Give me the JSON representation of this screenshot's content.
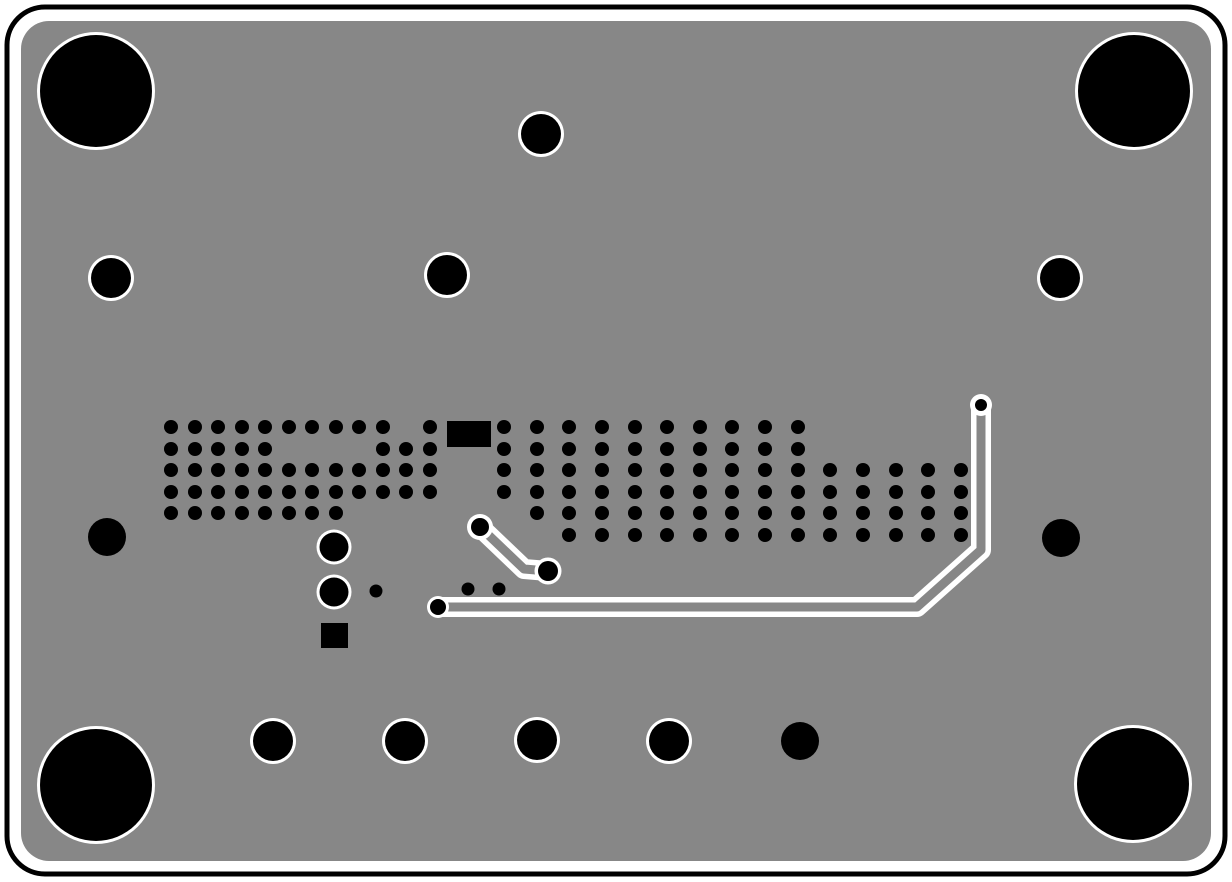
{
  "board": {
    "type": "pcb-layer-render",
    "canvas": {
      "width": 1232,
      "height": 882
    },
    "colors": {
      "background": "#ffffff",
      "substrate": "#878787",
      "drill": "#000000",
      "trace_outline": "#ffffff",
      "board_edge": "#000000"
    },
    "edge_outline": {
      "x": 7,
      "y": 7,
      "width": 1218,
      "height": 867,
      "radius": 38,
      "stroke_width": 5
    },
    "substrate": {
      "x": 21,
      "y": 21,
      "width": 1190,
      "height": 840,
      "radius": 28
    },
    "mounting_holes": {
      "radius": 56,
      "ring_width": 3,
      "positions": [
        [
          96,
          91
        ],
        [
          1134,
          91
        ],
        [
          96,
          785
        ],
        [
          1133,
          784
        ]
      ]
    },
    "ringed_holes": {
      "radius": 20,
      "ring_width": 3,
      "positions": [
        [
          541,
          134
        ],
        [
          111,
          278
        ],
        [
          447,
          275
        ],
        [
          1060,
          278
        ],
        [
          273,
          741
        ],
        [
          405,
          741
        ],
        [
          537,
          740
        ],
        [
          669,
          741
        ]
      ]
    },
    "plain_holes": {
      "radius": 19,
      "positions": [
        [
          107,
          537
        ],
        [
          1061,
          538
        ],
        [
          800,
          741
        ]
      ]
    },
    "ringed_vias": {
      "radius": 14.5,
      "ring_width": 3,
      "positions": [
        [
          334,
          547
        ],
        [
          334,
          592
        ]
      ]
    },
    "via_field": {
      "via_radius": 7,
      "rows": [
        {
          "y": 427,
          "xs": [
            171,
            195,
            218,
            242,
            265,
            289,
            312,
            336,
            359,
            383,
            430,
            504,
            537,
            569,
            602,
            635,
            667,
            700,
            732,
            765,
            798
          ]
        },
        {
          "y": 449,
          "xs": [
            171,
            195,
            218,
            242,
            265,
            383,
            406,
            430,
            504,
            537,
            569,
            602,
            635,
            667,
            700,
            732,
            765,
            798
          ]
        },
        {
          "y": 470,
          "xs": [
            171,
            195,
            218,
            242,
            265,
            289,
            312,
            336,
            359,
            383,
            406,
            430,
            504,
            537,
            569,
            602,
            635,
            667,
            700,
            732,
            765,
            798,
            830,
            863,
            896,
            928,
            961
          ]
        },
        {
          "y": 492,
          "xs": [
            171,
            195,
            218,
            242,
            265,
            289,
            312,
            336,
            359,
            383,
            406,
            430,
            504,
            537,
            569,
            602,
            635,
            667,
            700,
            732,
            765,
            798,
            830,
            863,
            896,
            928,
            961
          ]
        },
        {
          "y": 513,
          "xs": [
            171,
            195,
            218,
            242,
            265,
            289,
            312,
            336,
            537,
            569,
            602,
            635,
            667,
            700,
            732,
            765,
            798,
            830,
            863,
            896,
            928,
            961
          ]
        },
        {
          "y": 535,
          "xs": [
            569,
            602,
            635,
            667,
            700,
            732,
            765,
            798,
            830,
            863,
            896,
            928,
            961
          ]
        }
      ]
    },
    "loose_vias": {
      "radius": 6.5,
      "positions": [
        [
          376,
          591
        ],
        [
          468,
          589
        ],
        [
          499,
          589
        ]
      ]
    },
    "smd_pads": [
      {
        "x": 447,
        "y": 421,
        "width": 44,
        "height": 26
      },
      {
        "x": 321,
        "y": 623,
        "width": 27,
        "height": 25
      }
    ],
    "traces": {
      "outer_width": 20,
      "core_width": 9,
      "paths": [
        {
          "name": "long-trace",
          "points": [
            [
              438,
              607
            ],
            [
              917,
              607
            ],
            [
              981,
              550
            ],
            [
              981,
              405
            ]
          ]
        },
        {
          "name": "short-trace",
          "points": [
            [
              480,
              527
            ],
            [
              524,
              569
            ],
            [
              548,
              571
            ]
          ]
        }
      ]
    },
    "trace_terminals": [
      {
        "x": 438,
        "y": 607,
        "pad_radius": 11,
        "dot_radius": 8
      },
      {
        "x": 981,
        "y": 405,
        "pad_radius": 11,
        "dot_radius": 6
      },
      {
        "x": 480,
        "y": 527,
        "pad_radius": 13,
        "dot_radius": 9
      },
      {
        "x": 548,
        "y": 571,
        "pad_radius": 13.5,
        "dot_radius": 10
      }
    ]
  }
}
